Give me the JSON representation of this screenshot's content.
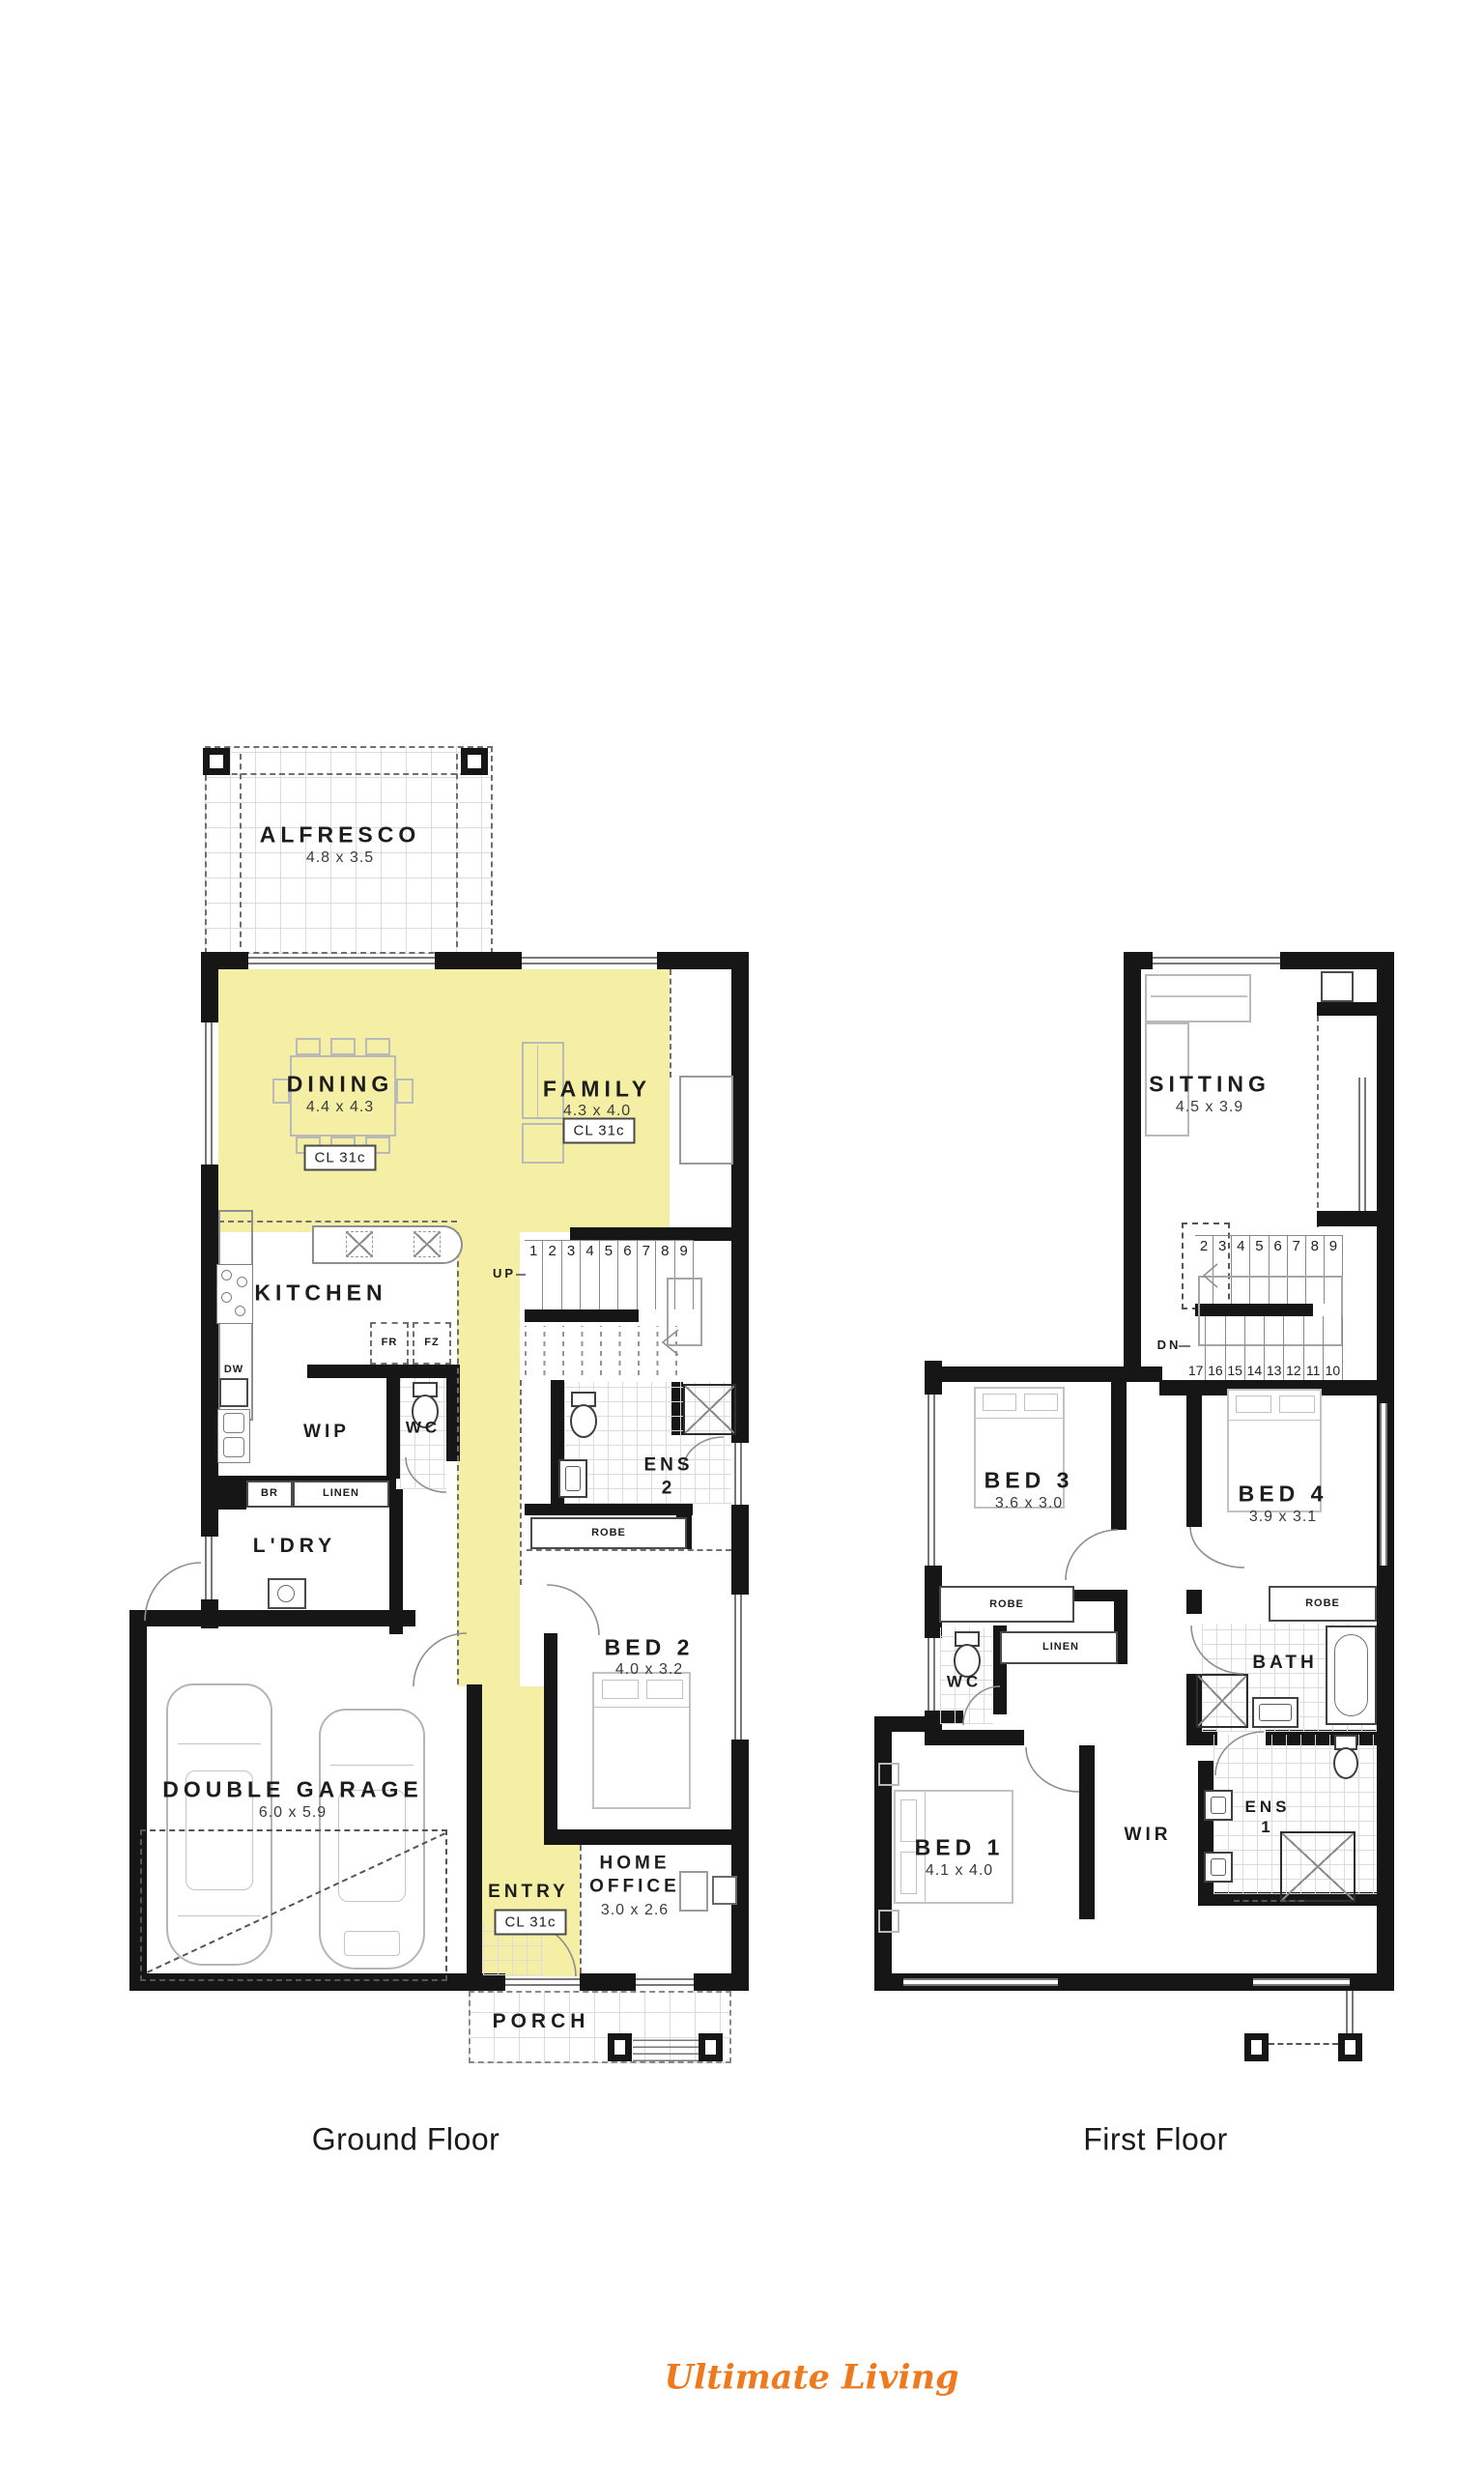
{
  "colors": {
    "highlight": "#F5EFA5",
    "wall": "#161616",
    "logo_orange": "#EF7A1E"
  },
  "captions": {
    "ground": "Ground Floor",
    "first": "First Floor"
  },
  "brand": {
    "name": "Ultimate Living"
  },
  "ground": {
    "alfresco": {
      "name": "ALFRESCO",
      "dims": "4.8 x 3.5"
    },
    "dining": {
      "name": "DINING",
      "dims": "4.4 x 4.3",
      "cl": "CL 31c"
    },
    "family": {
      "name": "FAMILY",
      "dims": "4.3 x 4.0",
      "cl": "CL 31c"
    },
    "kitchen": {
      "name": "KITCHEN"
    },
    "wip": {
      "name": "WIP"
    },
    "wc": {
      "name": "WC"
    },
    "ens2": {
      "name": "ENS 2"
    },
    "ldry": {
      "name": "L'DRY"
    },
    "bed2": {
      "name": "BED 2",
      "dims": "4.0 x 3.2"
    },
    "garage": {
      "name": "DOUBLE GARAGE",
      "dims": "6.0 x 5.9"
    },
    "entry": {
      "name": "ENTRY",
      "cl": "CL 31c"
    },
    "office": {
      "name": "HOME OFFICE",
      "dims": "3.0 x 2.6"
    },
    "porch": {
      "name": "PORCH"
    },
    "up": "UP",
    "fr": "FR",
    "fz": "FZ",
    "dw": "DW",
    "br": "BR",
    "linen": "LINEN",
    "robe": "ROBE",
    "stairs": [
      "1",
      "2",
      "3",
      "4",
      "5",
      "6",
      "7",
      "8",
      "9"
    ]
  },
  "first": {
    "sitting": {
      "name": "SITTING",
      "dims": "4.5 x 3.9"
    },
    "bed3": {
      "name": "BED 3",
      "dims": "3.6 x 3.0"
    },
    "bed4": {
      "name": "BED 4",
      "dims": "3.9 x 3.1"
    },
    "wc": {
      "name": "WC"
    },
    "bath": {
      "name": "BATH"
    },
    "bed1": {
      "name": "BED 1",
      "dims": "4.1 x 4.0"
    },
    "wir": {
      "name": "WIR"
    },
    "ens1": {
      "name": "ENS 1"
    },
    "dn": "DN",
    "linen": "LINEN",
    "robe_left": "ROBE",
    "robe_right": "ROBE",
    "stairs_top": [
      "2",
      "3",
      "4",
      "5",
      "6",
      "7",
      "8",
      "9"
    ],
    "stairs_bottom": [
      "17",
      "16",
      "15",
      "14",
      "13",
      "12",
      "11",
      "10"
    ]
  }
}
